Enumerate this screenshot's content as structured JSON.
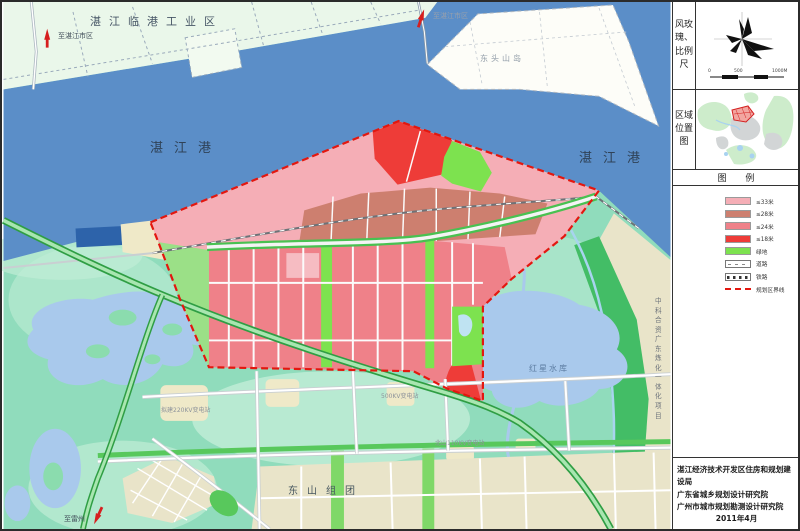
{
  "colors": {
    "sea": "#5b8ec8",
    "seaDeep": "#2d63aa",
    "strip": "#eaf7ea",
    "island": "#fdfdf8",
    "mint": "#90dcbc",
    "mintLight": "#c0ecd6",
    "sand": "#efe9c8",
    "town": "#e9e4c9",
    "lake": "#a9c9ec",
    "pinkLight": "#f5aeb6",
    "pink": "#ef8189",
    "pinkPale": "#f6bcc2",
    "salmon": "#cd7f6f",
    "red": "#ee3c38",
    "green": "#7de24f",
    "greenRoad": "#49c151",
    "greenBand": "#43bd66",
    "greenDark": "#2f9e44",
    "boundary": "#e3170f",
    "canal": "#a8d4ee",
    "roadCase": "#c9cfd2",
    "arrow": "#d61f1f"
  },
  "map": {
    "labels": {
      "industrial_zone": "湛江临港工业区",
      "to_city_left": "至湛江市区",
      "to_city_top": "至湛江市区",
      "island": "东头山岛",
      "port_left": "湛江港",
      "port_right": "湛江港",
      "reservoir": "红星水库",
      "refinery": "中科合资广东炼化一体化项目",
      "town": "东山组团",
      "to_leizhou": "至雷州",
      "sub220": "拟建220KV变电站",
      "sub500": "500KV变电站",
      "sub110": "北山110KV变电站"
    }
  },
  "panel": {
    "section1_label": "风玫瑰、比例尺",
    "section2_label": "区域位置图",
    "legend_title": "图 例",
    "scale_ticks": [
      "0",
      "500",
      "1000M"
    ],
    "legend": {
      "items": [
        {
          "label": "≤33米",
          "color": "#f5aeb6",
          "type": "swatch"
        },
        {
          "label": "≤28米",
          "color": "#cd7f6f",
          "type": "swatch"
        },
        {
          "label": "≤24米",
          "color": "#ef8189",
          "type": "swatch"
        },
        {
          "label": "≤18米",
          "color": "#ee3c38",
          "type": "swatch"
        },
        {
          "label": "绿地",
          "color": "#7de24f",
          "type": "swatch"
        },
        {
          "label": "道路",
          "color": "#ffffff",
          "type": "road"
        },
        {
          "label": "铁路",
          "color": "#ffffff",
          "type": "rail"
        },
        {
          "label": "规划区界线",
          "color": "#e3170f",
          "type": "dash"
        }
      ]
    },
    "attribution": {
      "lines": [
        "湛江经济技术开发区住房和规划建设局",
        "广东省城乡规划设计研究院",
        "广州市城市规划勘测设计研究院",
        "2011年4月"
      ]
    }
  }
}
